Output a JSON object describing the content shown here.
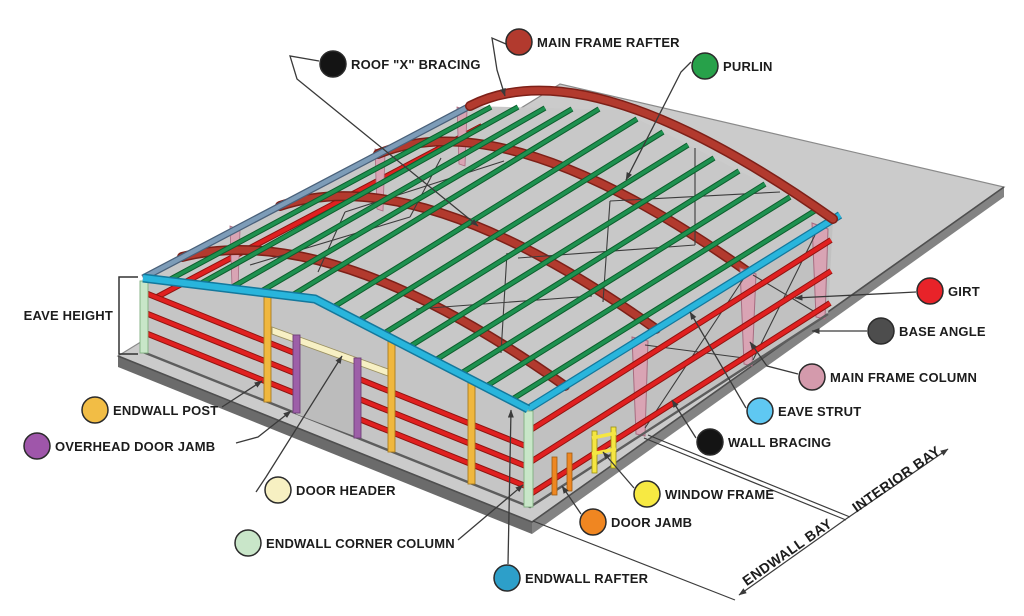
{
  "legend": {
    "main_frame_rafter": {
      "label": "MAIN FRAME RAFTER",
      "color": "#b23a2e"
    },
    "roof_x_bracing": {
      "label": "ROOF \"X\" BRACING",
      "color": "#141414"
    },
    "purlin": {
      "label": "PURLIN",
      "color": "#27a14a"
    },
    "girt": {
      "label": "GIRT",
      "color": "#e82329"
    },
    "base_angle": {
      "label": "BASE ANGLE",
      "color": "#4d4d4d"
    },
    "main_frame_column": {
      "label": "MAIN FRAME COLUMN",
      "color": "#d49aac"
    },
    "eave_strut": {
      "label": "EAVE STRUT",
      "color": "#5fc8f2"
    },
    "wall_bracing": {
      "label": "WALL BRACING",
      "color": "#141414"
    },
    "endwall_post": {
      "label": "ENDWALL POST",
      "color": "#f2bd45"
    },
    "overhead_door_jamb": {
      "label": "OVERHEAD DOOR JAMB",
      "color": "#9f56aa"
    },
    "door_header": {
      "label": "DOOR HEADER",
      "color": "#f7f0c2"
    },
    "endwall_corner_column": {
      "label": "ENDWALL CORNER COLUMN",
      "color": "#c9e6c9"
    },
    "endwall_rafter": {
      "label": "ENDWALL RAFTER",
      "color": "#2d9fc9"
    },
    "window_frame": {
      "label": "WINDOW FRAME",
      "color": "#f7e942"
    },
    "door_jamb": {
      "label": "DOOR JAMB",
      "color": "#f08621"
    }
  },
  "dimensions": {
    "eave_height": "EAVE HEIGHT",
    "endwall_bay": "ENDWALL BAY",
    "interior_bay": "INTERIOR BAY"
  },
  "colors": {
    "slab": "#cbcbcb",
    "slab_edge_left": "#6b6b6b",
    "slab_edge_right": "#838383",
    "silhouette": "#c8c8c8",
    "wall": "#c5c5c5",
    "sidewall": "#c1c1c1",
    "door_opening": "#bcbcbc",
    "rafter": "#b23a2e",
    "purlin": "#1e9150",
    "girt": "#e02020",
    "eave_strut": "#29b5dc",
    "far_eave_strut": "#7d9cb8",
    "main_frame_column": "#d9a4b4",
    "endwall_post": "#f0b73e",
    "overhead_door_jamb": "#9d5fa8",
    "door_header": "#f7f0c4",
    "corner_column": "#c8e6c8",
    "door_jamb": "#ee8722",
    "window_frame": "#f5e642",
    "bracing": "#3c3c3c",
    "leader": "#3a3a3a"
  }
}
